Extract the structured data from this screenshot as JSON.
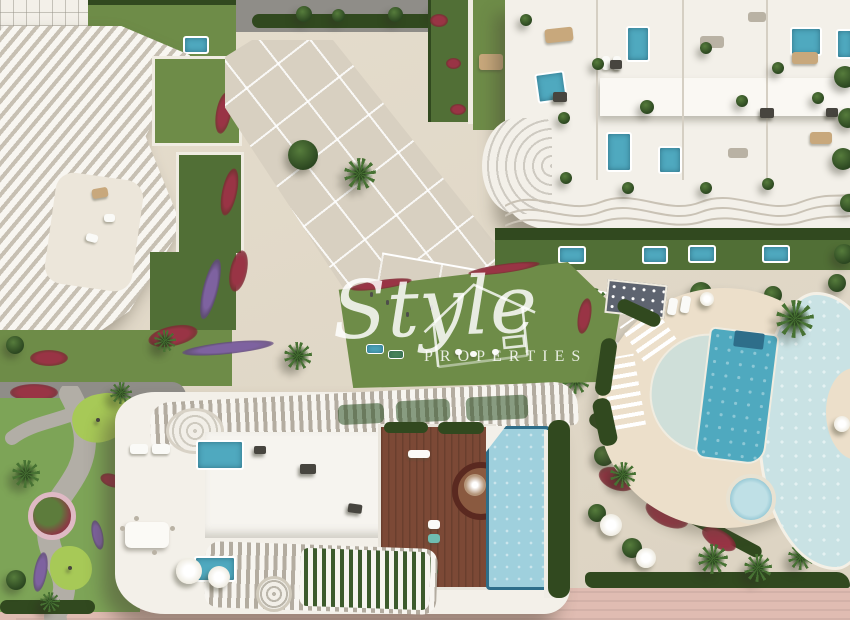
{
  "watermark": {
    "script": "Style",
    "caps": "PROPERTIES"
  },
  "palette": {
    "paving": "#e5ddcd",
    "plaza": "#d8d0c1",
    "road": "#8f8d88",
    "lawn": "#6e8c48",
    "lawn_dark": "#516f36",
    "hedge": "#31491f",
    "flowers_red": "#993445",
    "flowers_purple": "#7e62a0",
    "pool_teal": "#4fa9bf",
    "pool_pale": "#9fd0dd",
    "pool_lagoon": "#c9e2e4",
    "pool_border": "#2e6e8a",
    "wood_deck": "#7c4936",
    "deck_cream": "#ecdfca",
    "building_white": "#f3f0e9",
    "fin_shadow": "#c7c0b3",
    "promenade_pink": "#e0bcb2",
    "watermark_white": "rgba(255,255,255,0.84)"
  },
  "scene": {
    "type": "aerial-3d-render",
    "areas": [
      "top road",
      "north-west wave-fin apartment building",
      "north-east rooftop-terrace building with plunge pools",
      "central paved plaza",
      "central lawn",
      "access road",
      "communal pool deck with lap pool and lagoon pool",
      "penthouse roof terrace with wooden deck and pool",
      "mini-golf garden",
      "beach promenade"
    ]
  }
}
